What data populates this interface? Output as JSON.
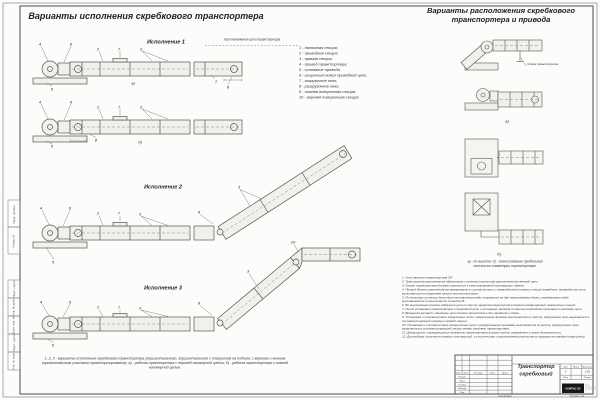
{
  "titles": {
    "left": "Варианты исполнения скребкового транспортера",
    "right_line1": "Варианты расположения скребкового",
    "right_line2": "транспортера и привода"
  },
  "executions": {
    "e1": "Исполнение 1",
    "e2": "Исполнение 2",
    "e3": "Исполнение 3",
    "tension_unit": "Узел натяжения цепи транспортера"
  },
  "legend": {
    "items": [
      "1 - натяжная секция;",
      "2 - приводная секция;",
      "3 - прямая секция;",
      "4 - привод транспортера;",
      "5 - основание привода;",
      "6 - защитный кожух приводной цепи;",
      "7 - загрузочное окно;",
      "8 - разгрузочное окно;",
      "9 - нижняя поворотная секция;",
      "10 - верхняя поворотная секция;"
    ]
  },
  "caption_left": "1, 2, 3 - варианты исполнения скребкового транспортера (горизонтального, горизонтального с поворотом на подъем, с верхним и нижним горизонтальным участком транспортирования); а) - работа транспортера с верхней натянутой цепью; б) - работа транспортера с нижней натянутой цепью.",
  "right_panel": {
    "support_label": "Опора транспортера",
    "caption_line1": "а) - по высоте; б) - относительно продольной",
    "caption_line2": "плоскости симметрии транспортера."
  },
  "notes": {
    "items": [
      "1. Угол наклона транспортера 30°.",
      "2. Транспортер выполняется обратимым с нижним (холостым) расположением ветвей цепи.",
      "3. Опоры транспортера должны крепиться к смонтированной конструкции здания.",
      "4. Привод (болты крепления) устанавливать в соответствии с переработкой опорных секций конвейера; переработка опор выполняется по нагрузкам секций против монтажа.",
      "5. По монтажу по месту болтовые неподвижные ряды опираются на две пересекаемые балки; передвижные ряды выставляются по высотам до отметки В.",
      "6. Во внутреннем сечении заборного узла по месту транспортера путем сложения конфигураций поворотных секций.",
      "7. После установки транспортера и приводной цепи и установки привода по месту необходимо произвести натяжку цепи.",
      "8. Вращение ветвей и движение цепи должно происходить без заеданий и сбоев.",
      "9. Установка и соответствие загрузочных окон с загрузочным проемом выполняется по месту; загрузочное окно вырезается в соответствующей проекции прямой секции.",
      "10. Установка и соответствие разгрузочных окон с разгрузочными проемами выполняется по месту; разгрузочное окно вырезается в соответствующей секции между секциями транспортера.",
      "11. Движущиеся и вращающиеся элементы транспортера должны иметь ограждения в целях безопасности.",
      "12. Для выбора и расчета опорных конструкций, их количества и расположения рассчитать нагрузку на каждую опору (узел)."
    ]
  },
  "callouts": [
    {
      "t": "4",
      "x": 40,
      "y": 44
    },
    {
      "t": "6",
      "x": 71,
      "y": 44
    },
    {
      "t": "2",
      "x": 98,
      "y": 49
    },
    {
      "t": "7",
      "x": 119,
      "y": 49
    },
    {
      "t": "3",
      "x": 141,
      "y": 49
    },
    {
      "t": "1",
      "x": 216,
      "y": 81
    },
    {
      "t": "8",
      "x": 228,
      "y": 87
    },
    {
      "t": "5",
      "x": 52,
      "y": 89
    },
    {
      "t": "а)",
      "x": 133,
      "y": 83
    },
    {
      "t": "4",
      "x": 40,
      "y": 102
    },
    {
      "t": "6",
      "x": 71,
      "y": 102
    },
    {
      "t": "2",
      "x": 98,
      "y": 107
    },
    {
      "t": "7",
      "x": 119,
      "y": 107
    },
    {
      "t": "3",
      "x": 141,
      "y": 107
    },
    {
      "t": "8",
      "x": 96,
      "y": 140
    },
    {
      "t": "5",
      "x": 52,
      "y": 146
    },
    {
      "t": "б)",
      "x": 140,
      "y": 142
    },
    {
      "t": "4",
      "x": 41,
      "y": 208
    },
    {
      "t": "6",
      "x": 70,
      "y": 208
    },
    {
      "t": "2",
      "x": 98,
      "y": 213
    },
    {
      "t": "7",
      "x": 119,
      "y": 213
    },
    {
      "t": "3",
      "x": 140,
      "y": 214
    },
    {
      "t": "9",
      "x": 199,
      "y": 212
    },
    {
      "t": "3",
      "x": 239,
      "y": 187
    },
    {
      "t": "5",
      "x": 53,
      "y": 262
    },
    {
      "t": "4",
      "x": 41,
      "y": 302
    },
    {
      "t": "6",
      "x": 70,
      "y": 302
    },
    {
      "t": "2",
      "x": 98,
      "y": 307
    },
    {
      "t": "7",
      "x": 119,
      "y": 307
    },
    {
      "t": "3",
      "x": 140,
      "y": 308
    },
    {
      "t": "9",
      "x": 199,
      "y": 303
    },
    {
      "t": "3",
      "x": 248,
      "y": 271
    },
    {
      "t": "10",
      "x": 293,
      "y": 242
    },
    {
      "t": "5",
      "x": 53,
      "y": 345
    },
    {
      "t": "а)",
      "x": 507,
      "y": 121
    },
    {
      "t": "б)",
      "x": 499,
      "y": 254
    }
  ],
  "stamp": {
    "title_line1": "Транспортер",
    "title_line2": "скребковый",
    "headers": {
      "izm": "Изм.",
      "list": "Лист",
      "doc": "№ докум.",
      "podp": "Подп.",
      "data": "Дата"
    },
    "rows": [
      "Разраб.",
      "Пров.",
      "Т.контр.",
      "Н.контр.",
      "Утв."
    ],
    "right": {
      "lit": "Лит.",
      "mass": "Масса",
      "scale_h": "Масштаб",
      "lit_val": "У",
      "scale": "1:20",
      "sheet": "Лист",
      "sheets": "Листов"
    },
    "logo": "КОМПАС-3D",
    "logo_side": "Не для коммерческого использования",
    "footer_copy": "Копировал",
    "footer_format": "Формат А1"
  },
  "frame": {
    "labels": [
      "Перв. примен.",
      "Справ. №",
      "Подп. и дата",
      "Инв. № дубл.",
      "Взам. инв. №",
      "Подп. и дата",
      "Инв. № подл."
    ]
  }
}
